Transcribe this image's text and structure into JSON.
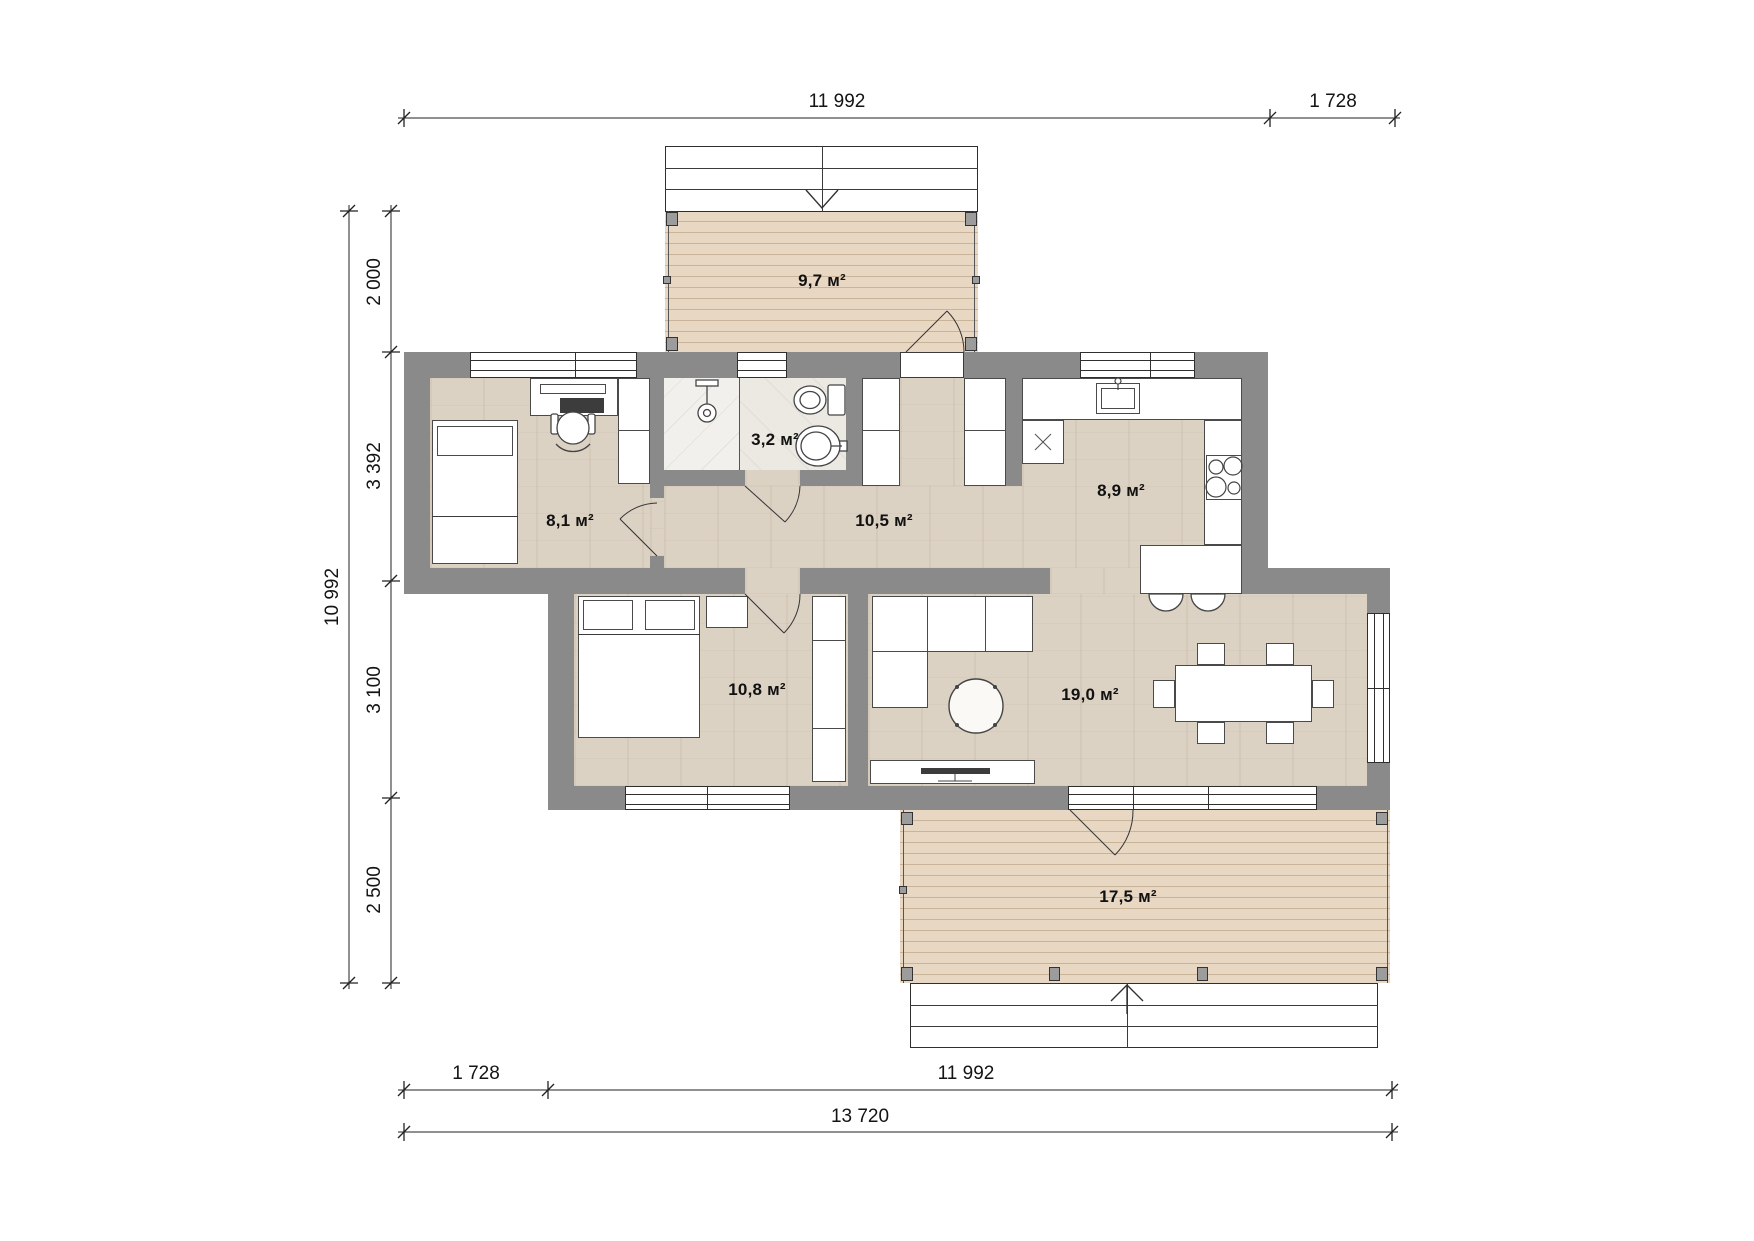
{
  "page": {
    "type": "architectural-floor-plan",
    "background": "#ffffff"
  },
  "colors": {
    "wall": "#8a8a8a",
    "floor_wood": "#dcd2c4",
    "deck_wood": "#e8d7c2",
    "deck_line": "#c9b49a",
    "tile": "#ece9e3",
    "tile_shower": "#f2f0ec",
    "line": "#2f2f2f",
    "dim": "#141414",
    "white": "#ffffff"
  },
  "rooms": [
    {
      "id": "terrace-top",
      "area": "9,7 м²"
    },
    {
      "id": "kids-room",
      "area": "8,1 м²"
    },
    {
      "id": "bathroom",
      "area": "3,2 м²"
    },
    {
      "id": "hallway",
      "area": "10,5 м²"
    },
    {
      "id": "kitchen",
      "area": "8,9 м²"
    },
    {
      "id": "bedroom",
      "area": "10,8 м²"
    },
    {
      "id": "living-room",
      "area": "19,0 м²"
    },
    {
      "id": "terrace-bottom",
      "area": "17,5 м²"
    }
  ],
  "dimensions": {
    "top": [
      "11 992",
      "1 728"
    ],
    "left_overall": "10 992",
    "left": [
      "2 000",
      "3 392",
      "3 100",
      "2 500"
    ],
    "bottom": [
      "1 728",
      "11 992"
    ],
    "bottom_overall": "13 720"
  },
  "icons": {
    "shower": "shower-head",
    "toilet": "toilet",
    "sink": "wash-basin",
    "stove": "4-burner-cooktop",
    "entry_arrow_top": "arrow-down-entry",
    "entry_arrow_bottom": "arrow-up-entry"
  }
}
